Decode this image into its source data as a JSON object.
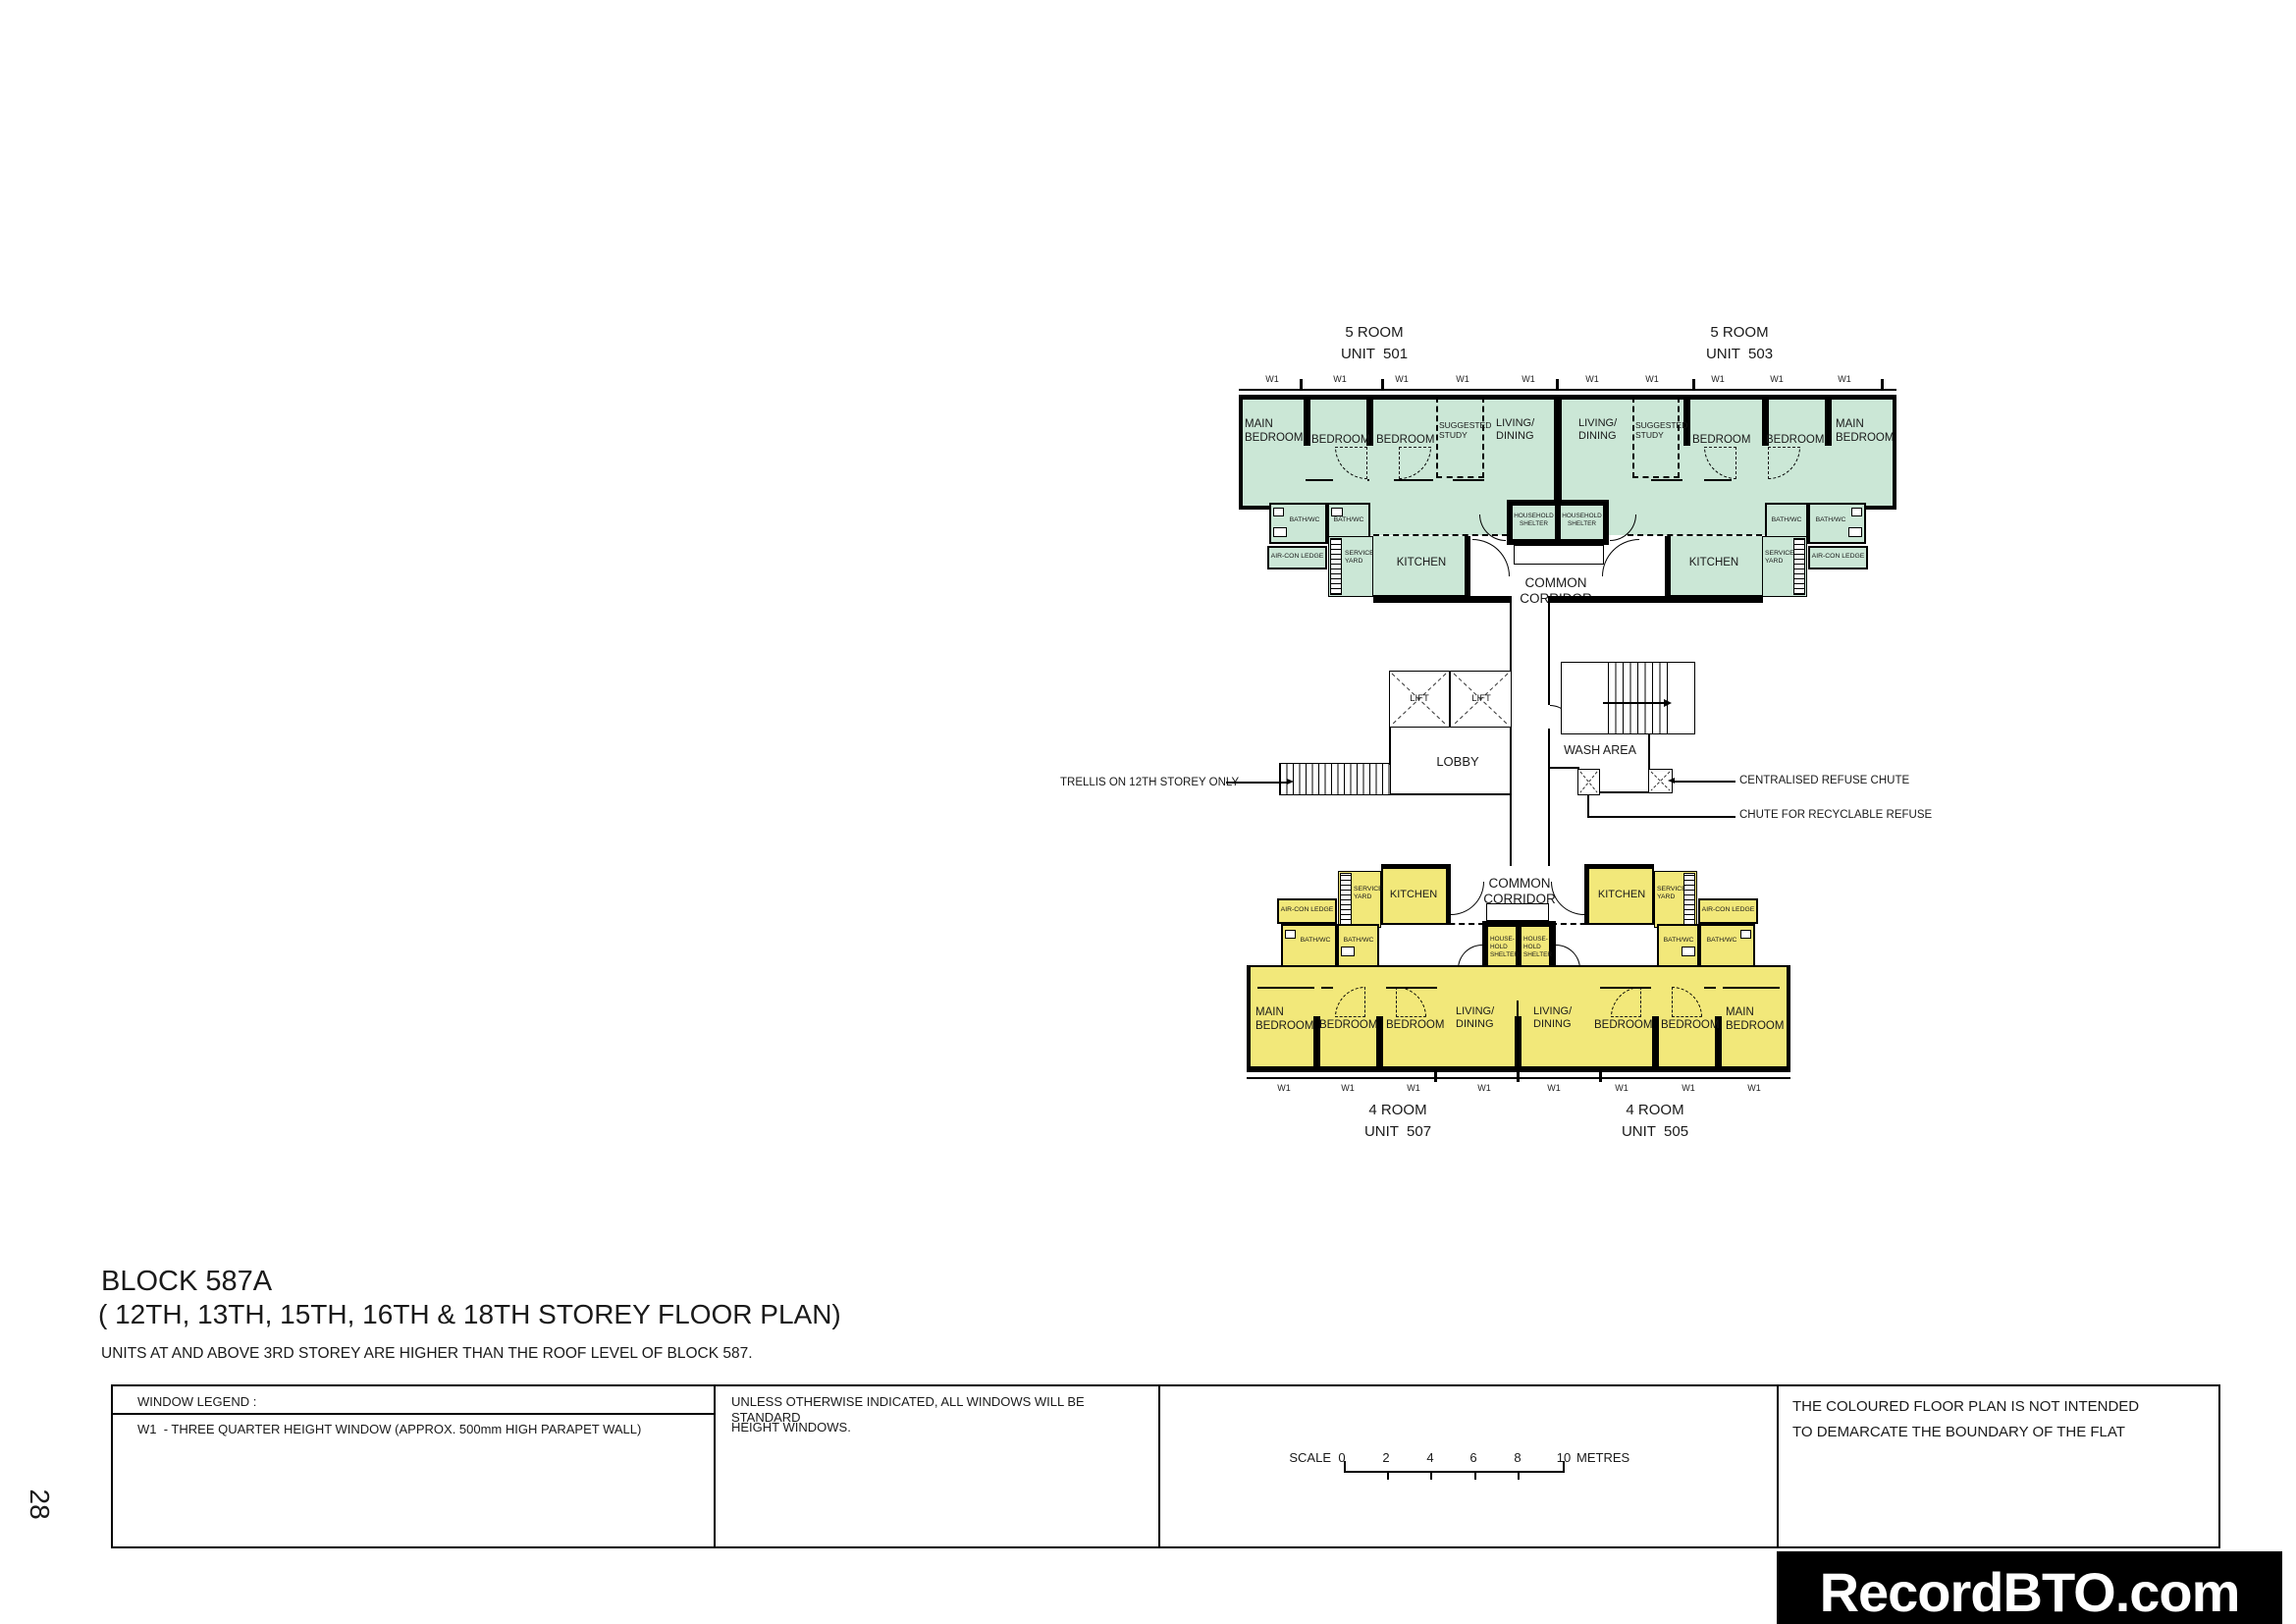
{
  "page": {
    "number": "28"
  },
  "title": {
    "block": "BLOCK 587A",
    "storeys": "( 12TH, 13TH, 15TH, 16TH & 18TH STOREY FLOOR PLAN)",
    "note": "UNITS AT AND ABOVE 3RD STOREY ARE HIGHER THAN THE ROOF LEVEL OF BLOCK 587."
  },
  "units": {
    "unit501": {
      "type": "5 ROOM",
      "number": "UNIT  501"
    },
    "unit503": {
      "type": "5 ROOM",
      "number": "UNIT  503"
    },
    "unit507": {
      "type": "4 ROOM",
      "number": "UNIT  507"
    },
    "unit505": {
      "type": "4 ROOM",
      "number": "UNIT  505"
    }
  },
  "rooms": {
    "main_bedroom": "MAIN\nBEDROOM",
    "bedroom": "BEDROOM",
    "suggested_study": "SUGGESTED\nSTUDY",
    "living_dining": "LIVING/\nDINING",
    "kitchen": "KITCHEN",
    "bath_wc": "BATH/WC",
    "service_yard": "SERVICE\nYARD",
    "aircon_ledge": "AIR-CON LEDGE",
    "household_shelter2": "HOUSEHOLD\nSHELTER",
    "household_shelter3": "HOUSE-\nHOLD\nSHELTER"
  },
  "plan_labels": {
    "common_corridor": "COMMON CORRIDOR",
    "lift": "LIFT",
    "lobby": "LOBBY",
    "wash_area": "WASH AREA",
    "window_tag": "W1"
  },
  "annotations": {
    "trellis": "TRELLIS ON 12TH STOREY ONLY",
    "centralised_chute": "CENTRALISED REFUSE CHUTE",
    "recyclable_chute": "CHUTE FOR RECYCLABLE REFUSE"
  },
  "legend": {
    "header": "WINDOW LEGEND :",
    "w1_desc": "W1  - THREE QUARTER HEIGHT WINDOW (APPROX. 500mm HIGH PARAPET WALL)",
    "windows_note_line1": "UNLESS OTHERWISE INDICATED, ALL WINDOWS WILL BE STANDARD",
    "windows_note_line2": "HEIGHT WINDOWS.",
    "coloured_note_line1": "THE COLOURED FLOOR PLAN IS NOT INTENDED",
    "coloured_note_line2": "TO DEMARCATE THE BOUNDARY OF THE FLAT"
  },
  "scale_bar": {
    "label": "SCALE",
    "ticks": [
      "0",
      "2",
      "4",
      "6",
      "8",
      "10"
    ],
    "unit": "METRES"
  },
  "watermark": "RecordBTO.com",
  "colors": {
    "five_room_fill": "#cbe7d6",
    "four_room_fill": "#f2e87a",
    "wall": "#000000",
    "watermark_bg": "#000000"
  }
}
